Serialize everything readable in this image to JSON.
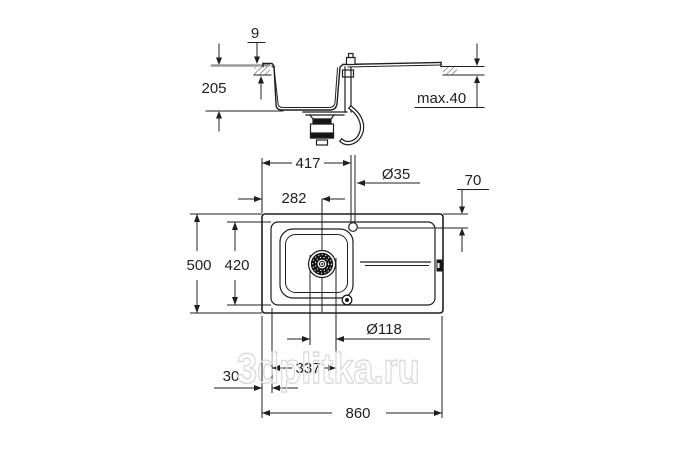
{
  "drawing": {
    "type": "sink-installation-dimension-drawing",
    "watermark": "3dplitka.ru",
    "section_view": {
      "dims": {
        "rim_height": "9",
        "bowl_depth": "205",
        "max_counter_thickness": "max.40"
      }
    },
    "top_view": {
      "dims": {
        "faucet_offset_x": "417",
        "drain_offset_x": "282",
        "faucet_hole_diameter": "Ø35",
        "faucet_offset_y": "70",
        "overall_depth": "500",
        "inner_rim_depth": "420",
        "drain_diameter": "Ø118",
        "drain_span": "337",
        "edge_margin": "30",
        "overall_width": "860"
      }
    },
    "colors": {
      "line": "#1f1f1f",
      "countertop_line": "#9a9a9a",
      "watermark": "#d9d9d9",
      "background": "#ffffff"
    }
  }
}
